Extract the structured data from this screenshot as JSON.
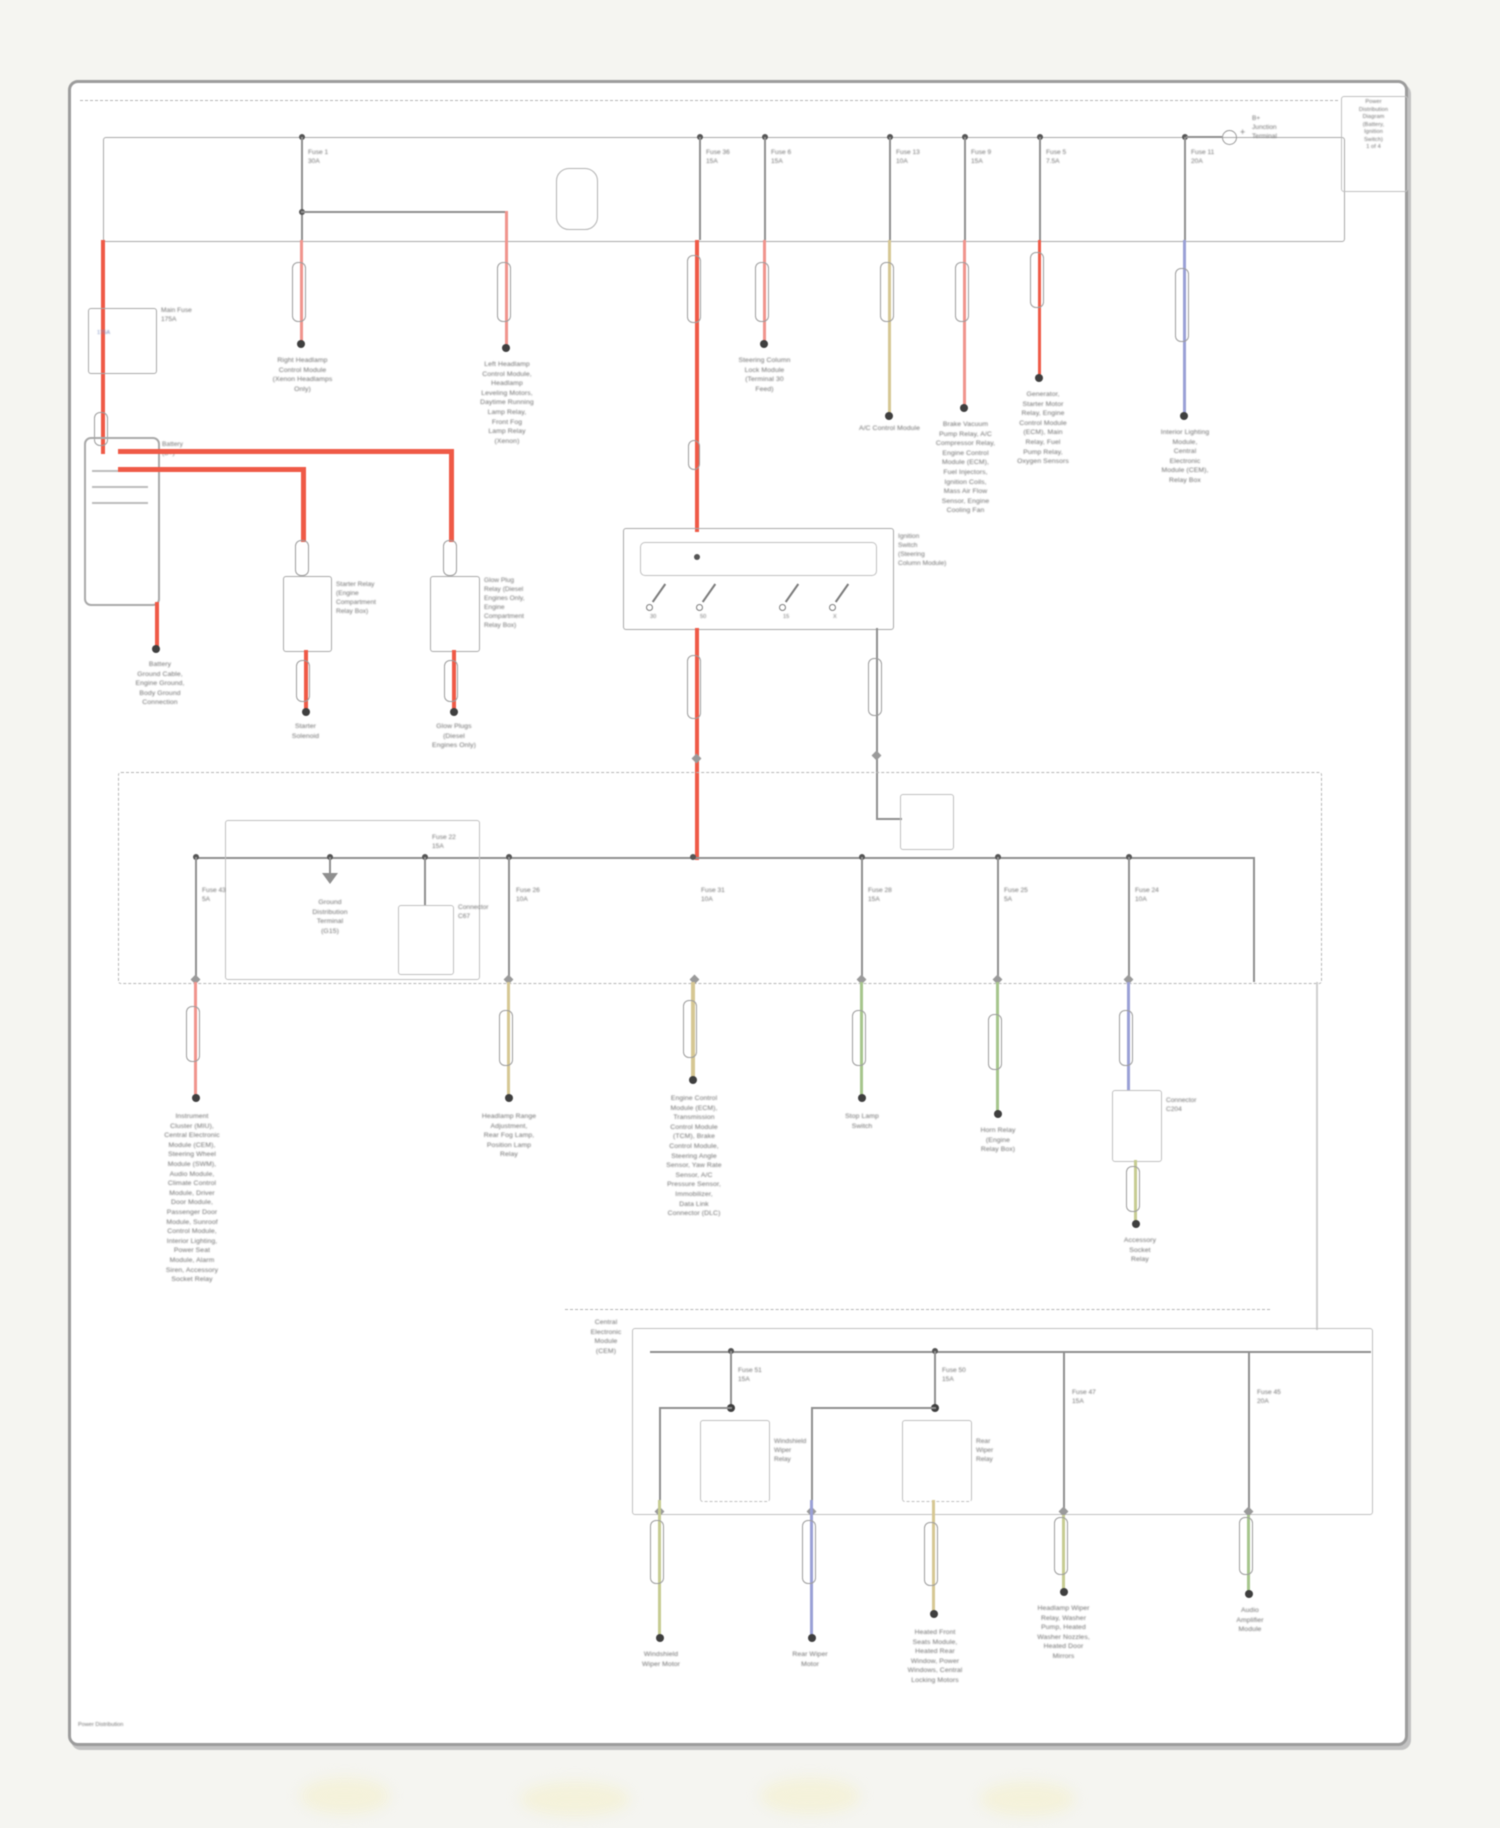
{
  "meta": {
    "doc_type": "wiring-diagram",
    "subject": "Power Distribution",
    "footer": "Power Distribution",
    "colors": {
      "wire_grey": "#8f8f8f",
      "wire_red": "#ef5a47",
      "wire_pink": "#f0948d",
      "wire_tan": "#d6c793",
      "wire_green": "#a6c58c",
      "wire_blue": "#9aa0d6",
      "wire_yellow_green": "#c6cc92",
      "border_grey": "#9c9c9c",
      "text_grey": "#6e6e6e"
    }
  },
  "labels": {
    "corner_note": "Power\nDistribution\nDiagram\n(Battery,\nIgnition\nSwitch)\n1 of 4",
    "bplus": "B+\nJunction\nTerminal",
    "plus_sign": "+",
    "f_302": "Fuse 1\n30A",
    "f_700": "Fuse 36\n15A",
    "f_765": "Fuse 6\n15A",
    "f_890": "Fuse 13\n10A",
    "f_965": "Fuse 9\n15A",
    "f_1040": "Fuse 5\n7.5A",
    "f_1185": "Fuse 11\n20A",
    "t_302": "Right Headlamp\nControl Module\n(Xenon Headlamps\nOnly)",
    "t_507": "Left Headlamp\nControl Module,\nHeadlamp\nLeveling Motors,\nDaytime Running\nLamp Relay,\nFront Fog\nLamp Relay\n(Xenon)",
    "t_765": "Steering Column\nLock Module\n(Terminal 30\nFeed)",
    "t_890": "A/C Control Module",
    "t_965": "Brake Vacuum\nPump Relay, A/C\nCompressor Relay,\nEngine Control\nModule (ECM),\nFuel Injectors,\nIgnition Coils,\nMass Air Flow\nSensor, Engine\nCooling Fan",
    "t_1040": "Generator,\nStarter Motor\nRelay, Engine\nControl Module\n(ECM), Main\nRelay, Fuel\nPump Relay,\nOxygen Sensors",
    "t_1185": "Interior Lighting\nModule,\nCentral\nElectronic\nModule (CEM),\nRelay Box",
    "mainfuse": "Main Fuse\n175A",
    "mainfuse_amp": "175A",
    "battery": "Battery\n(B+)",
    "t_batt": "Battery\nGround Cable,\nEngine Ground,\nBody Ground\nConnection",
    "relayA": "Starter Relay\n(Engine\nCompartment\nRelay Box)",
    "relayB": "Glow Plug\nRelay (Diesel\nEngines Only,\nEngine\nCompartment\nRelay Box)",
    "t_A": "Starter\nSolenoid",
    "t_B": "Glow Plugs\n(Diesel\nEngines Only)",
    "ign": "Ignition\nSwitch\n(Steering\nColumn Module)",
    "ign_t1": "30",
    "ign_t2": "50",
    "ign_t3": "15",
    "ign_t4": "X",
    "f_196": "Fuse 43\n5A",
    "gnd": "Ground\nDistribution\nTerminal\n(G15)",
    "f_connC": "Fuse 22\n15A",
    "connC": "Connector\nC67",
    "f_509": "Fuse 26\n10A",
    "f_693": "Fuse 31\n10A",
    "f_862": "Fuse 28\n15A",
    "f_998": "Fuse 25\n5A",
    "f_1129": "Fuse 24\n10A",
    "t_196": "Instrument\nCluster (MIU),\nCentral Electronic\nModule (CEM),\nSteering Wheel\nModule (SWM),\nAudio Module,\nClimate Control\nModule, Driver\nDoor Module,\nPassenger Door\nModule, Sunroof\nControl Module,\nInterior Lighting,\nPower Seat\nModule, Alarm\nSiren, Accessory\nSocket Relay",
    "t_509": "Headlamp Range\nAdjustment,\nRear Fog Lamp,\nPosition Lamp\nRelay",
    "t_693": "Engine Control\nModule (ECM),\nTransmission\nControl Module\n(TCM), Brake\nControl Module,\nSteering Angle\nSensor, Yaw Rate\nSensor, A/C\nPressure Sensor,\nImmobilizer,\nData Link\nConnector (DLC)",
    "t_862": "Stop Lamp\nSwitch",
    "t_998": "Horn Relay\n(Engine\nRelay Box)",
    "boxD": "Connector\nC204",
    "t_1136": "Accessory\nSocket\nRelay",
    "cem": "Central\nElectronic\nModule\n(CEM)",
    "f_731": "Fuse 51\n15A",
    "relayF1": "Windshield\nWiper\nRelay",
    "f_935b": "Fuse 50\n15A",
    "relayF2": "Rear\nWiper\nRelay",
    "f_1065": "Fuse 47\n15A",
    "f_1250": "Fuse 45\n20A",
    "t_660": "Windshield\nWiper Motor",
    "t_812": "Rear Wiper\nMotor",
    "t_935": "Heated Front\nSeats Module,\nHeated Rear\nWindow, Power\nWindows, Central\nLocking Motors",
    "t_1065": "Headlamp Wiper\nRelay, Washer\nPump, Heated\nWasher Nozzles,\nHeated Door\nMirrors",
    "t_1250": "Audio\nAmplifier\nModule",
    "footer": "Power Distribution"
  }
}
